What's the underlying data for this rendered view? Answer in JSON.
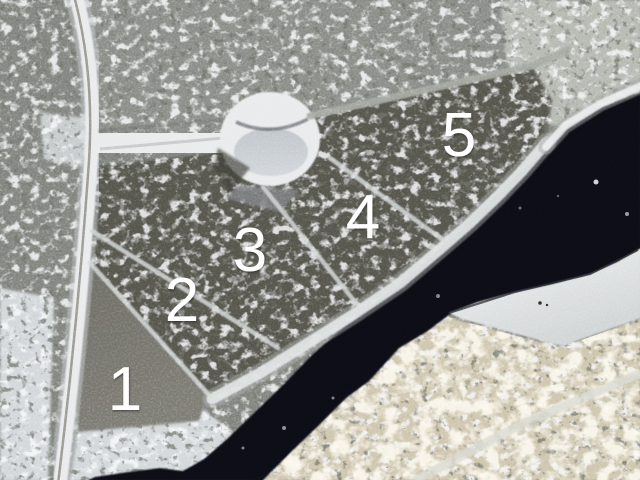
{
  "canvas": {
    "width": 640,
    "height": 480
  },
  "lots": [
    {
      "label": "1",
      "x": 125,
      "y": 410
    },
    {
      "label": "2",
      "x": 182,
      "y": 321
    },
    {
      "label": "3",
      "x": 250,
      "y": 271
    },
    {
      "label": "4",
      "x": 363,
      "y": 238
    },
    {
      "label": "5",
      "x": 459,
      "y": 156
    }
  ],
  "palette": {
    "water": "#0c0e13",
    "snow_bright": "#eef0f2",
    "snow_shaded": "#c5cacd",
    "bank_snow": "#d3d8da",
    "shore_snow": "#e2e6e6",
    "road_surface": "#e9ebec",
    "loop_center": "#c7ccd2",
    "forest_base": "#82857f",
    "forest_dark": "#56564d",
    "forest_north": "#8b8e88",
    "cleared_ground": "#6f6e67",
    "sunlit_forest": "#cfc6ae",
    "sunlit_snow": "#b7bab2",
    "apron_gray": "#7c7e80",
    "label": "#ffffff"
  }
}
